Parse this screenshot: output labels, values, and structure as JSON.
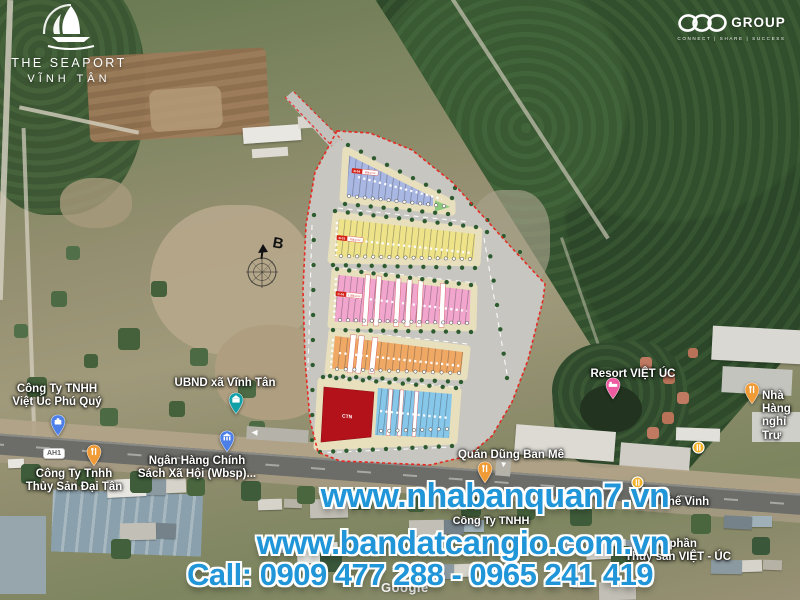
{
  "branding": {
    "seaport": {
      "name": "THE SEAPORT",
      "location": "VĨNH TÂN"
    },
    "csc": {
      "name": "GROUP",
      "tagline": "CONNECT | SHARE | SUCCESS"
    }
  },
  "map": {
    "compass_label": "B",
    "road_badge": "AH1",
    "google_watermark": "Google",
    "labels": [
      {
        "id": "viet-uc-phu-quy",
        "text": "Công Ty TNHH\nViệt Úc Phú Quý",
        "pin": "briefcase",
        "pin_color": "#4D7FE8"
      },
      {
        "id": "ubnd-vinh-tan",
        "text": "UBND xã Vĩnh Tân",
        "pin": "government",
        "pin_color": "#12A0A8"
      },
      {
        "id": "ngan-hang",
        "text": "Ngân Hàng Chính\nSách Xã Hội (Wbsp)...",
        "pin": "bank",
        "pin_color": "#4D7FE8"
      },
      {
        "id": "thuy-san-dai-tan",
        "text": "Công Ty Tnhh\nThủy Sản Đại Tân",
        "pin": "restaurant",
        "pin_color": "#F09B35"
      },
      {
        "id": "quan-dung-ban-me",
        "text": "Quán Dũng Ban Mê",
        "pin": "restaurant",
        "pin_color": "#F09B35"
      },
      {
        "id": "resort-viet-uc",
        "text": "Resort VIỆT ÚC",
        "pin": "hotel",
        "pin_color": "#EF5BA0"
      },
      {
        "id": "nha-hang-nghi",
        "text": "Nhà Hàng\nnghỉ Trư",
        "pin": "restaurant",
        "pin_color": "#F09B35"
      },
      {
        "id": "the-vinh",
        "text": "Thế Vinh"
      },
      {
        "id": "cong-ty-tnhh",
        "text": "Công Ty TNHH"
      },
      {
        "id": "thuy-san-viet-uc",
        "text": "ổ phần\nThủy sản VIỆT - ÚC"
      }
    ]
  },
  "plan": {
    "boundary_color": "#E8241C",
    "blocks": [
      {
        "id": "blue-row",
        "label": "B-04",
        "area": "958.4 m²",
        "color": "#A9B7E3"
      },
      {
        "id": "yellow-row",
        "label": "B-03",
        "area": "768.4 m²",
        "color": "#EFE38A"
      },
      {
        "id": "pink-row",
        "label": "C-04",
        "area": "1,358.4 m²",
        "color": "#F2A6CE"
      },
      {
        "id": "orange-row",
        "color": "#F0A964"
      },
      {
        "id": "lightblue-row",
        "color": "#86C7EA"
      },
      {
        "id": "ctn-lot",
        "label": "CTN",
        "color": "#B3121A"
      },
      {
        "id": "green-lot",
        "color": "#8CC97C"
      }
    ]
  },
  "watermark": {
    "site1": "www.nhabanquan7.vn",
    "site2": "www.bandatcangio.com.vn",
    "phone": "Call: 0909 477 288 - 0965 241 419",
    "color": "#2095D8"
  }
}
